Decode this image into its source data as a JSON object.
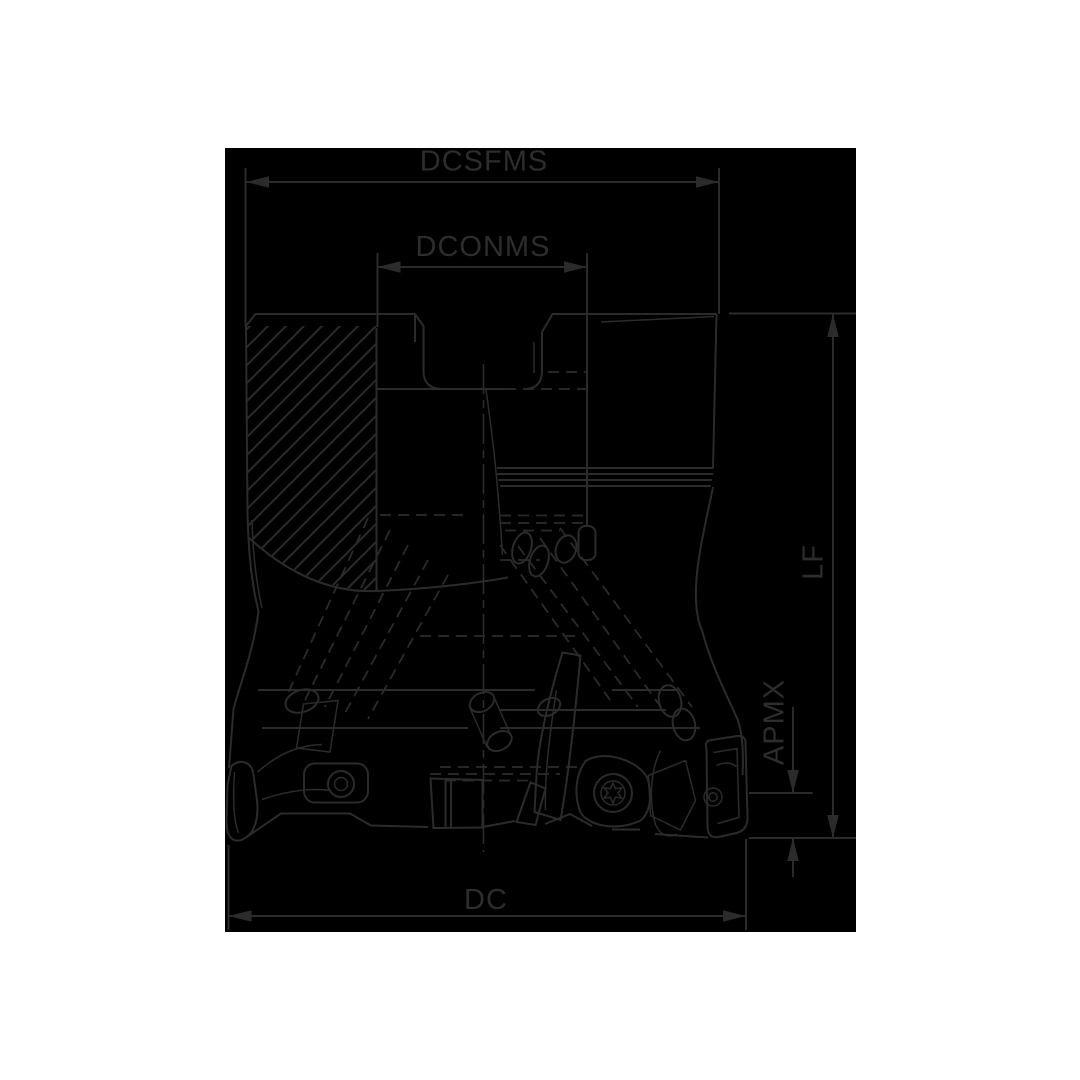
{
  "labels": {
    "dcsfms": "DCSFMS",
    "dconms": "DCONMS",
    "lf": "LF",
    "apmx": "APMX",
    "dc": "DC"
  },
  "colors": {
    "canvas": "#ffffff",
    "plate": "#000000",
    "line": "#2b2b2b"
  },
  "drawing": {
    "kind": "milling-cutter-dimension-diagram",
    "dimensions": [
      {
        "label": "DCSFMS",
        "orientation": "horizontal",
        "position": "top"
      },
      {
        "label": "DCONMS",
        "orientation": "horizontal",
        "position": "top-inner"
      },
      {
        "label": "LF",
        "orientation": "vertical",
        "position": "right"
      },
      {
        "label": "APMX",
        "orientation": "vertical",
        "position": "right-lower"
      },
      {
        "label": "DC",
        "orientation": "horizontal",
        "position": "bottom"
      }
    ]
  }
}
